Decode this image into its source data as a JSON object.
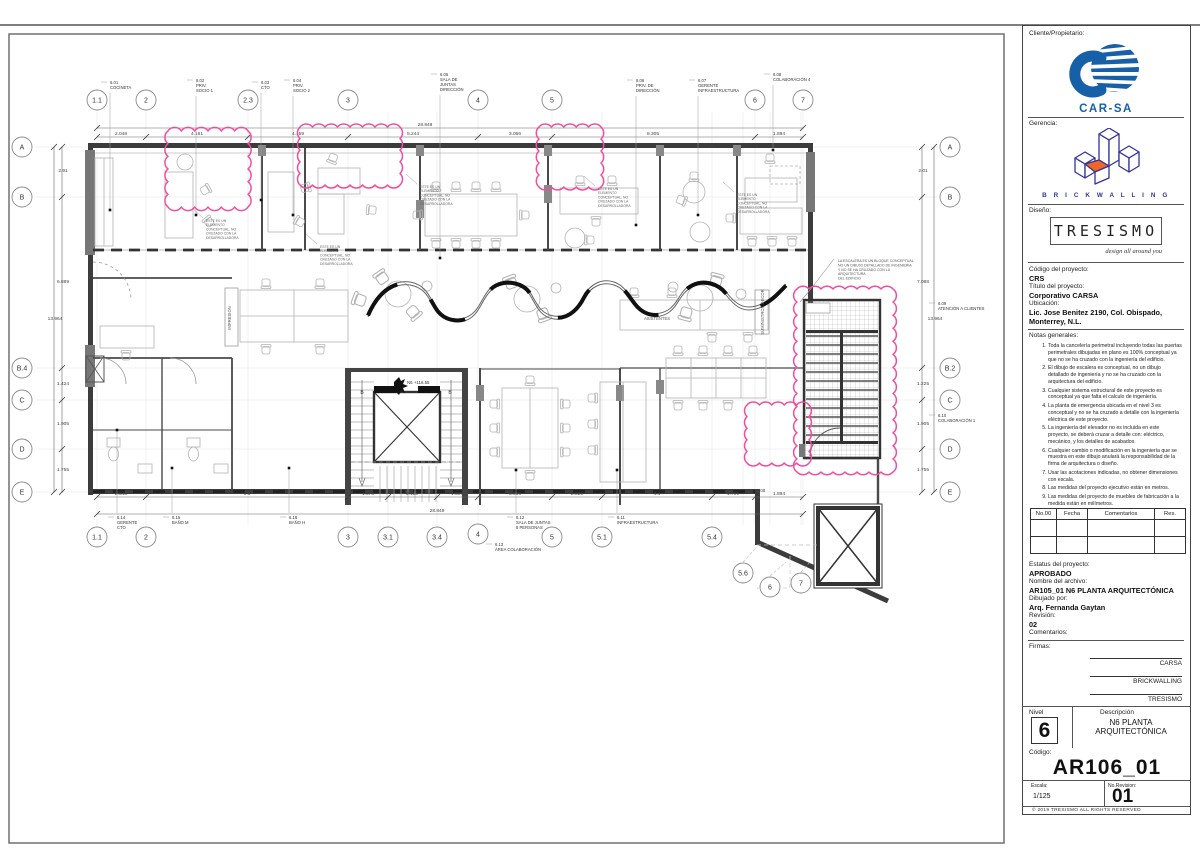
{
  "titleblock": {
    "client_label": "Cliente/Propietario:",
    "client_name": "CAR-SA",
    "management_label": "Gerencia:",
    "management_name": "B R I C K W A L L I N G",
    "design_label": "Diseño:",
    "design_name": "TRESISMO",
    "design_tagline": "design all around you",
    "project_code_label": "Código del proyecto:",
    "project_code": "CRS",
    "project_title_label": "Título del proyecto:",
    "project_title": "Corporativo CARSA",
    "location_label": "Ubicación:",
    "location_line1": "Lic. Jose Benitez 2190, Col. Obispado,",
    "location_line2": "Monterrey, N.L.",
    "notes_label": "Notas generales:",
    "notes": [
      "Toda la cancelería perimetral incluyendo todas las puertas perimetrales dibujadas en plano es 100% conceptual ya que no se ha cruzado con la ingeniería del edificio.",
      "El dibujo de escalera es conceptual, no un dibujo detallado de ingeniería y no se ha cruzado con la arquitectura del edificio.",
      "Cualquier sistema estructural de este proyecto es conceptual ya que falta el calculo de ingeniería.",
      "La planta de emergencia ubicada en el nivel 3 es conceptual y no se ha cruzado a detalle con la ingeniería eléctrica de este proyecto.",
      "La ingeniería del elevador no es incluida en este proyecto, se deberá cruzar a detalle con: eléctrico, mecánico, y los detalles de acabados.",
      "Cualquier cambio o modificación en la ingeniería que se muestra en este dibujo anulará la responsabilidad de la firma de arquitectura o diseño.",
      "Usar las acotaciones indicadas, no obtener dimensiones con escala.",
      "Las medidas del proyecto ejecutivo están en metros.",
      "Las medidas del proyecto de muebles de fabricación a la medida están en milímetros."
    ],
    "revision_table_headers": [
      "No.00",
      "Fecha",
      "Comentarios",
      "Res."
    ],
    "status_label": "Estatus del proyecto:",
    "status": "APROBADO",
    "file_label": "Nombre del archivo:",
    "file_name": "AR105_01 N6 PLANTA ARQUITECTÓNICA",
    "drawn_label": "Dibujado por:",
    "drawn_by": "Arq. Fernanda Gaytan",
    "revision_label": "Revisión:",
    "revision": "02",
    "comments_label": "Comentarios:",
    "signatures_label": "Firmas:",
    "signatures": [
      "CARSA",
      "BRICKWALLING",
      "TRESISMO"
    ],
    "level_label": "Nivel",
    "level": "6",
    "description_label": "Descripción",
    "description_line1": "N6 PLANTA",
    "description_line2": "ARQUITECTÓNICA",
    "code_label": "Código:",
    "sheet_code": "AR106_01",
    "scale_label": "Escala:",
    "scale": "1/125",
    "revno_label": "No.Revision:",
    "revno": "01",
    "copyright": "©      2019 TRESISMO ALL RIGHTS RESERVED"
  },
  "plan": {
    "colors": {
      "cloud_pink": "#ee4f9e",
      "carsa_blue": "#1660a8",
      "brick_navy": "#33339b",
      "brick_orange": "#f06623"
    },
    "grids_top": [
      {
        "l": "1.1",
        "x": 97
      },
      {
        "l": "2",
        "x": 146
      },
      {
        "l": "2.3",
        "x": 248
      },
      {
        "l": "3",
        "x": 348
      },
      {
        "l": "4",
        "x": 478
      },
      {
        "l": "5",
        "x": 552
      },
      {
        "l": "6",
        "x": 755
      },
      {
        "l": "7",
        "x": 803
      }
    ],
    "grids_bottom": [
      {
        "l": "1.1",
        "x": 97,
        "y": 537
      },
      {
        "l": "2",
        "x": 146,
        "y": 537
      },
      {
        "l": "3",
        "x": 348,
        "y": 537
      },
      {
        "l": "3.1",
        "x": 388,
        "y": 537
      },
      {
        "l": "3.4",
        "x": 437,
        "y": 537
      },
      {
        "l": "4",
        "x": 478,
        "y": 534
      },
      {
        "l": "5",
        "x": 552,
        "y": 537
      },
      {
        "l": "5.1",
        "x": 602,
        "y": 537
      },
      {
        "l": "5.4",
        "x": 712,
        "y": 537
      },
      {
        "l": "5.6",
        "x": 743,
        "y": 573
      },
      {
        "l": "6",
        "x": 770,
        "y": 587
      },
      {
        "l": "7",
        "x": 801,
        "y": 583
      }
    ],
    "grids_left": [
      {
        "l": "A",
        "y": 147
      },
      {
        "l": "B",
        "y": 197
      },
      {
        "l": "B.4",
        "y": 368
      },
      {
        "l": "C",
        "y": 400
      },
      {
        "l": "D",
        "y": 449
      },
      {
        "l": "E",
        "y": 492
      }
    ],
    "grids_right": [
      {
        "l": "A",
        "y": 147
      },
      {
        "l": "B",
        "y": 197
      },
      {
        "l": "B.2",
        "y": 368
      },
      {
        "l": "C",
        "y": 400
      },
      {
        "l": "D",
        "y": 449
      },
      {
        "l": "E",
        "y": 492
      }
    ],
    "dims": {
      "top_overall": {
        "label": "28.849",
        "y": 128,
        "x1": 97,
        "x2": 803,
        "lx": 425
      },
      "top_segments": {
        "y": 137,
        "ticks": [
          97,
          146,
          248,
          348,
          478,
          552,
          755,
          803
        ],
        "labels": [
          {
            "t": "2.048",
            "x": 121
          },
          {
            "t": "4.161",
            "x": 197
          },
          {
            "t": "4.159",
            "x": 298
          },
          {
            "t": "5.244",
            "x": 413
          },
          {
            "t": "3.056",
            "x": 515
          },
          {
            "t": "8.305",
            "x": 653
          },
          {
            "t": "1.894",
            "x": 779
          }
        ]
      },
      "bottom_segments": {
        "y": 497,
        "ticks": [
          97,
          146,
          348,
          388,
          437,
          478,
          552,
          602,
          712,
          755,
          803
        ],
        "labels": [
          {
            "t": "2.048",
            "x": 121
          },
          {
            "t": "8.3",
            "x": 247
          },
          {
            "t": "1.570",
            "x": 368
          },
          {
            "t": "2.115",
            "x": 412
          },
          {
            "t": "1.609",
            "x": 457
          },
          {
            "t": "3.056",
            "x": 515
          },
          {
            "t": "2.026",
            "x": 577
          },
          {
            "t": "4.4",
            "x": 657
          },
          {
            "t": "1.799",
            "x": 733
          },
          {
            "t": "1.894",
            "x": 779
          }
        ]
      },
      "bottom_overall": {
        "label": "28.849",
        "y": 514,
        "x1": 97,
        "x2": 803,
        "lx": 437
      },
      "left_segments": {
        "x": 62,
        "ticks": [
          147,
          197,
          368,
          400,
          449,
          492
        ],
        "labels": [
          {
            "t": "2.91",
            "y": 172
          },
          {
            "t": "6.889",
            "y": 283
          },
          {
            "t": "1.424",
            "y": 385
          },
          {
            "t": "1.905",
            "y": 425
          },
          {
            "t": "1.755",
            "y": 471
          }
        ]
      },
      "left_overall": {
        "label": "13.964",
        "x": 54,
        "y1": 147,
        "y2": 492,
        "ly": 320
      },
      "right_segments": {
        "x": 922,
        "ticks": [
          147,
          197,
          368,
          400,
          449,
          492
        ],
        "labels": [
          {
            "t": "2.01",
            "y": 172
          },
          {
            "t": "7.088",
            "y": 283
          },
          {
            "t": "1.225",
            "y": 385
          },
          {
            "t": "1.905",
            "y": 425
          },
          {
            "t": "1.755",
            "y": 471
          }
        ]
      },
      "right_overall": {
        "label": "13.964",
        "x": 934,
        "y1": 147,
        "y2": 492,
        "ly": 320
      },
      "extra": [
        {
          "t": "3.08",
          "x": 761,
          "y": 492
        }
      ]
    },
    "rooms": [
      {
        "code": "6.01",
        "name": [
          "COCINETA"
        ],
        "x": 110,
        "y": 84,
        "leadTo": 210
      },
      {
        "code": "6.02",
        "name": [
          "PRIV.",
          "SOCIO 1"
        ],
        "x": 196,
        "y": 82,
        "leadTo": 215
      },
      {
        "code": "6.03",
        "name": [
          "CTO"
        ],
        "x": 261,
        "y": 84,
        "leadTo": 200
      },
      {
        "code": "6.04",
        "name": [
          "PRIV.",
          "SOCIO 2"
        ],
        "x": 293,
        "y": 82,
        "leadTo": 215
      },
      {
        "code": "6.05",
        "name": [
          "SALA DE",
          "JUNTAS",
          "DIRECCIÓN"
        ],
        "x": 440,
        "y": 76,
        "leadTo": 258
      },
      {
        "code": "6.06",
        "name": [
          "PRIV. DE",
          "DIRECCIÓN"
        ],
        "x": 636,
        "y": 82,
        "leadTo": 225
      },
      {
        "code": "6.07",
        "name": [
          "GERENTE",
          "INFRAESTRUCTURA"
        ],
        "x": 698,
        "y": 82,
        "leadTo": 215
      },
      {
        "code": "6.08",
        "name": [
          "COLABORACIÓN 4"
        ],
        "x": 773,
        "y": 76,
        "leadTo": 150
      },
      {
        "code": "6.09",
        "name": [
          "ATENCIÓN A CLIENTES"
        ],
        "x": 938,
        "y": 305
      },
      {
        "code": "6.10",
        "name": [
          "COLABORACIÓN 1"
        ],
        "x": 938,
        "y": 417
      },
      {
        "code": "6.14",
        "name": [
          "GERENTE",
          "CTO"
        ],
        "x": 117,
        "y": 519,
        "leadUp": 430
      },
      {
        "code": "6.15",
        "name": [
          "BAÑO M"
        ],
        "x": 172,
        "y": 519,
        "leadUp": 468
      },
      {
        "code": "6.16",
        "name": [
          "BAÑO H"
        ],
        "x": 289,
        "y": 519,
        "leadUp": 468
      },
      {
        "code": "6.12",
        "name": [
          "SALA DE JUNTAS",
          "8 PERSONAS"
        ],
        "x": 516,
        "y": 519,
        "leadUp": 470
      },
      {
        "code": "6.13",
        "name": [
          "ÁREA COLABORACIÓN"
        ],
        "x": 495,
        "y": 546
      },
      {
        "code": "6.11",
        "name": [
          "INFRAESTRUCTURA"
        ],
        "x": 617,
        "y": 519,
        "leadUp": 470
      }
    ],
    "clouds": [
      {
        "x": 168,
        "y": 131,
        "w": 80,
        "h": 76
      },
      {
        "x": 300,
        "y": 127,
        "w": 100,
        "h": 58
      },
      {
        "x": 539,
        "y": 127,
        "w": 62,
        "h": 60
      },
      {
        "x": 797,
        "y": 289,
        "w": 96,
        "h": 183
      },
      {
        "x": 747,
        "y": 405,
        "w": 62,
        "h": 58
      }
    ],
    "annotations": [
      {
        "lines": [
          "ESTE ES UN",
          "ELEMENTO",
          "CONCEPTUAL, NO",
          "CRUZADO CON LA",
          "DESARROLLADORA"
        ],
        "x": 206,
        "y": 222
      },
      {
        "lines": [
          "ESTE ES UN",
          "ELEMENTO",
          "CONCEPTUAL, NO",
          "CRUZADO CON LA",
          "DESARROLLADORA"
        ],
        "x": 320,
        "y": 248
      },
      {
        "lines": [
          "ESTE ES UN",
          "ELEMENTO",
          "CONCEPTUAL, NO",
          "CRUZADO CON LA",
          "DESARROLLADORA"
        ],
        "x": 420,
        "y": 188
      },
      {
        "lines": [
          "ESTE ES UN",
          "ELEMENTO",
          "CONCEPTUAL, NO",
          "CRUZADO CON LA",
          "DESARROLLADORA"
        ],
        "x": 598,
        "y": 190
      },
      {
        "lines": [
          "ESTE ES UN",
          "ELEMENTO",
          "CONCEPTUAL, NO",
          "CRUZADO CON LA",
          "DESARROLLADORA"
        ],
        "x": 737,
        "y": 196
      }
    ],
    "stair_note": {
      "lines": [
        "LA ESCALERA ES UN BLOQUE CONCEPTUAL",
        "NO UN DIBUJO DETALLADO DE INGENIERIA",
        "Y NO SE HA CRUZADO CON LA",
        "ARQUITECTURA",
        "DEL EDIFICIO"
      ],
      "x": 838,
      "y": 262
    },
    "level_marker": {
      "text": "N6 +116.55",
      "x": 404,
      "y": 384
    },
    "area_labels": [
      {
        "t": "IMPRESIÓN",
        "x": 231,
        "y": 318,
        "rot": -90
      },
      {
        "t": "ASISTENTES",
        "x": 657,
        "y": 320,
        "rot": 0
      },
      {
        "t": "SUMINISTROS DECOR",
        "x": 764,
        "y": 312,
        "rot": -90
      }
    ],
    "section_markers": [
      {
        "t": "B",
        "x": 362,
        "y": 394
      },
      {
        "t": "B",
        "x": 450,
        "y": 394
      }
    ]
  }
}
